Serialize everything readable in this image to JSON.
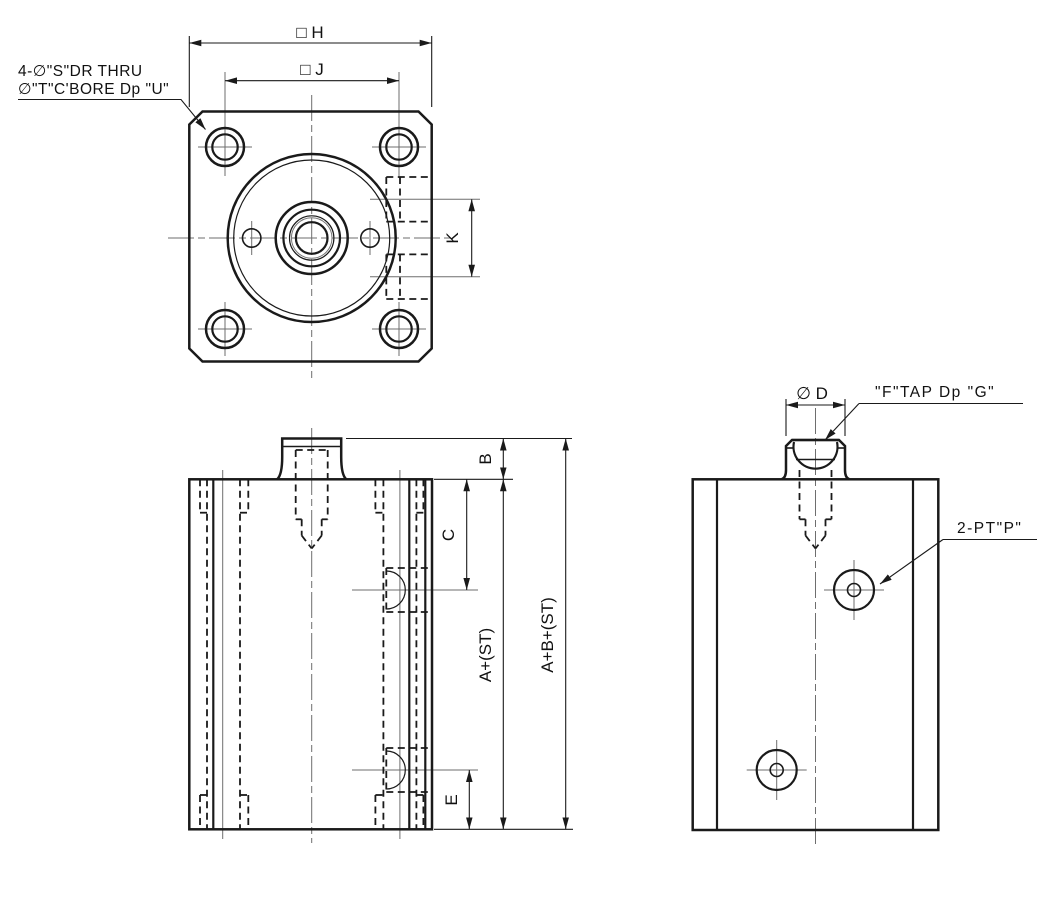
{
  "drawing": {
    "background": "#ffffff",
    "line_color": "#1a1a1a",
    "centerline_color": "#6e6e6e"
  },
  "front_view": {
    "note_line1": "4-∅\"S\"DR THRU",
    "note_line2": "∅\"T\"C'BORE Dp \"U\"",
    "dim_flange_width": "□ H",
    "dim_bolt_spacing": "□ J",
    "dim_port_spacing": "K"
  },
  "side_view": {
    "dim_boss_height": "B",
    "dim_top_to_port": "C",
    "dim_body_length": "A+(ST)",
    "dim_total_length": "A+B+(ST)",
    "dim_port_to_bottom": "E"
  },
  "end_view": {
    "dim_boss_diameter": "∅ D",
    "note_rod_tap": "\"F\"TAP Dp \"G\"",
    "note_ports": "2-PT\"P\""
  }
}
